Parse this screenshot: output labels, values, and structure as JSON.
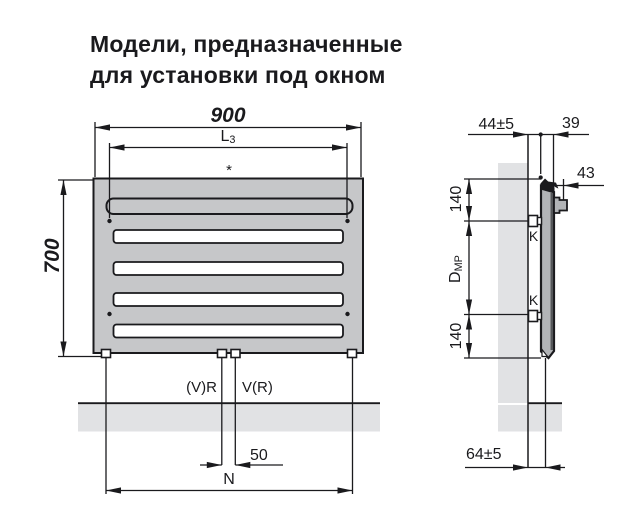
{
  "title": {
    "line1": "Модели, предназначенные",
    "line2": "для установки под окном"
  },
  "front_view": {
    "dim_width": "900",
    "dim_mount_width": {
      "base": "L",
      "sub": "3"
    },
    "footnote_mark": "*",
    "dim_height": "700",
    "conn_left": "(V)R",
    "conn_right": "V(R)",
    "dim_pipe_spacing": "50",
    "dim_conn_width": "N"
  },
  "side_view": {
    "dim_wall_gap": "44±5",
    "dim_depth": "39",
    "dim_rail_offset": "43",
    "dim_bracket_top": "140",
    "dim_bracket_spacing": {
      "base": "D",
      "sub": "MP"
    },
    "dim_bracket_bottom": "140",
    "dim_conn_wall_gap": "64±5",
    "bracket_top_label": "K",
    "bracket_bottom_label": "K"
  },
  "colors": {
    "panel_fill": "#c6c7c9",
    "wall_fill": "#e1e2e4",
    "profile_fill": "#b2b4b7",
    "line": "#1a1a1d"
  }
}
